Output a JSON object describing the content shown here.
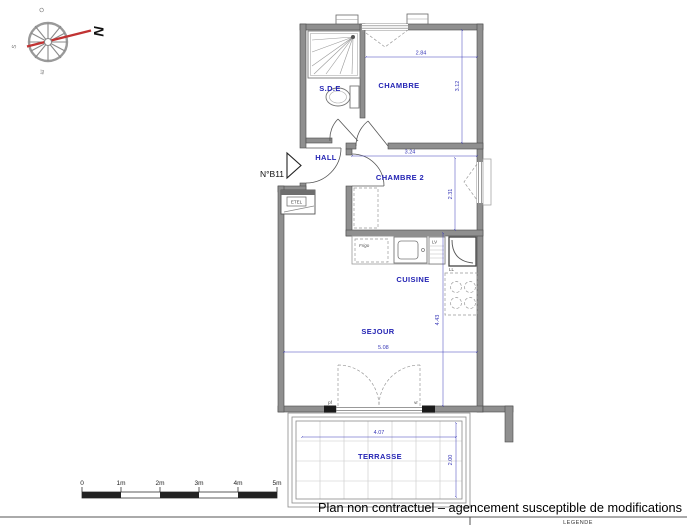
{
  "plan": {
    "unit_number": "N°B11",
    "rooms": {
      "sde": "S.D.E",
      "chambre": "CHAMBRE",
      "hall": "HALL",
      "chambre2": "CHAMBRE 2",
      "cuisine": "CUISINE",
      "sejour": "SEJOUR",
      "terrasse": "TERRASSE"
    },
    "dimensions": {
      "chambre_width": "2.84",
      "chambre_depth": "3.12",
      "chambre2_width": "3.24",
      "chambre2_depth": "2.31",
      "sejour_width": "5.08",
      "sejour_depth": "4.43",
      "terrasse_width": "4.07",
      "terrasse_depth": "2.00"
    },
    "fixtures": {
      "fridge": "Frigo",
      "dishwasher": "LV",
      "washing_machine": "LL",
      "technical_closet": "ETEL",
      "door_pf": "pf",
      "door_vr": "vr"
    }
  },
  "compass": {
    "north": "N",
    "west": "O",
    "south": "S",
    "east": "E"
  },
  "scale_bar": {
    "labels": [
      "0",
      "1m",
      "2m",
      "3m",
      "4m",
      "5m"
    ]
  },
  "footer": {
    "disclaimer": "Plan non contractuel – agencement susceptible de modifications",
    "legend_title": "LEGENDE"
  },
  "colors": {
    "label_blue": "#2424b4",
    "dimension_blue": "#3a3ab8",
    "wall_gray": "#8f8f8f",
    "needle_red": "#c13333",
    "text_black": "#111111"
  }
}
